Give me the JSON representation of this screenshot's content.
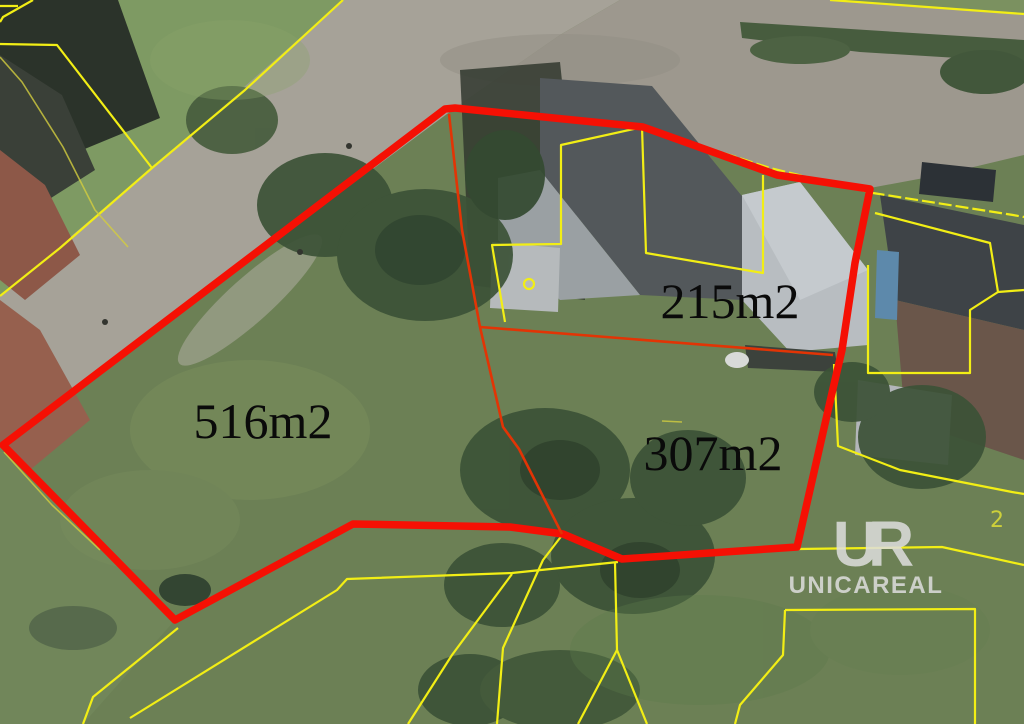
{
  "map": {
    "type": "cadastral-aerial-map",
    "watermark": {
      "monogram": "UR",
      "name": "UNICAREAL"
    },
    "parcels": [
      {
        "label": "516m2",
        "area_m2": 516
      },
      {
        "label": "215m2",
        "area_m2": 215
      },
      {
        "label": "307m2",
        "area_m2": 307
      }
    ],
    "stray_parcel_digit": "2",
    "colors": {
      "highlight_red": "#f51004",
      "division_red": "#e23405",
      "cadastral_yellow": "#f2ee15",
      "label_black": "#0a0a0a",
      "watermark_gray": "#dedede"
    },
    "red_outline": {
      "outer_points": "455,108 643,127 777,175 870,189 855,263 842,350 832,393 797,547 622,559 563,534 510,527 353,524 175,620 3,445 445,109",
      "division1_points": "449,114 462,230 480,327 503,427 519,449 562,534",
      "division2_points": "480,327 833,355"
    },
    "yellow_lines": [
      "0,44 57,45 152,168 60,248 0,296",
      "343,0 245,90 152,168",
      "0,57 22,82 63,147 95,210 128,247",
      "830,0 1024,14",
      "643,127 770,168 873,193 1013,215 1024,217",
      "642,127 646,253 763,273 763,175",
      "643,127 561,145 561,244 492,245 505,322",
      "875,213 990,243 998,292 1024,290",
      "868,265 868,373 970,373 970,310 998,292",
      "799,549 942,547 1024,565",
      "834,364 838,446 900,470 1012,492 1024,494",
      "785,610 975,609 975,724",
      "785,610 783,655 740,705 735,724",
      "618,562 512,573 347,579 337,590 130,718",
      "615,563 617,650 647,724",
      "617,650 578,724",
      "563,534 543,560 503,648 497,724",
      "512,574 452,655 408,724",
      "178,628 93,697 83,724",
      "4,452 52,505 100,550",
      "0,6 18,6",
      "33,0 3,17 0,22",
      "662,421 682,422"
    ],
    "survey_point": {
      "cx": 529,
      "cy": 284,
      "r": 5
    }
  }
}
